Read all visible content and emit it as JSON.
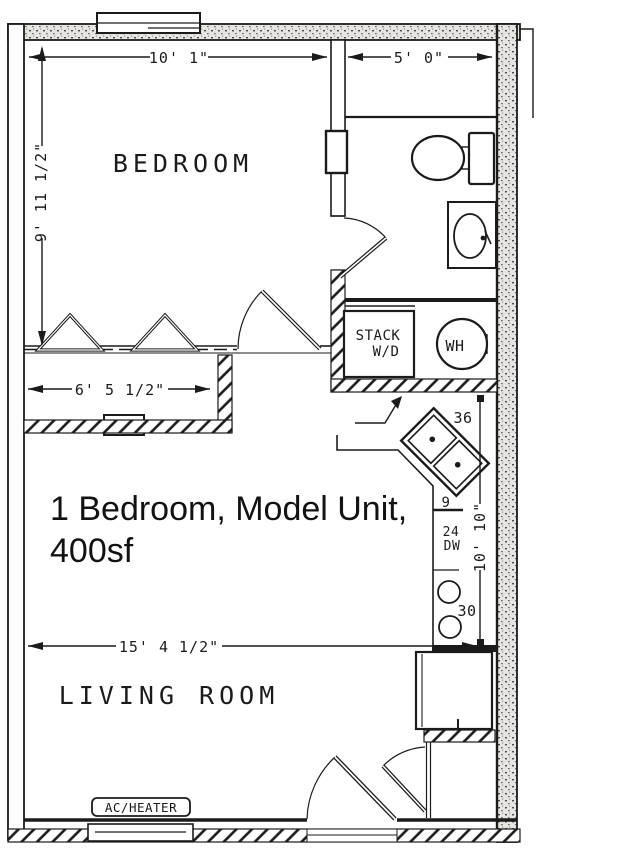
{
  "title_overlay": {
    "line1": "1 Bedroom, Model Unit,",
    "line2": "400sf"
  },
  "rooms": {
    "bedroom": "BEDROOM",
    "living_room": "LIVING ROOM"
  },
  "dimensions": {
    "bedroom_width": "10' 1\"",
    "bathroom_width": "5' 0\"",
    "bedroom_depth": "9' 11 1/2\"",
    "closet_width": "6' 5 1/2\"",
    "living_room_width": "15' 4 1/2\"",
    "kitchen_wall_length": "10' 10\""
  },
  "labels": {
    "stack_wd_line1": "STACK",
    "stack_wd_line2": "W/D",
    "water_heater": "WH",
    "corner_sink_width": "36",
    "filler_cabinet_width": "9",
    "dishwasher_width": "24",
    "dishwasher": "DW",
    "range_width": "30",
    "ac_heater": "AC/HEATER"
  }
}
